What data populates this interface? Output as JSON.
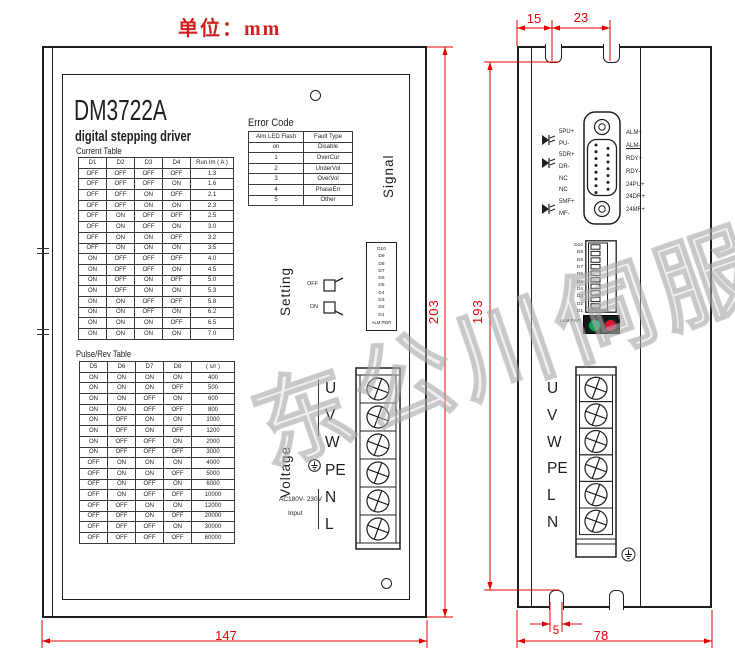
{
  "unit_label": "单位：mm",
  "watermark": "东公川伺服",
  "left_view": {
    "model": "DM3722A",
    "subtitle": "digital stepping driver",
    "signal_label": "Signal",
    "setting_label": "Setting",
    "voltage_label": "Voltage",
    "switch_off": "OFF",
    "switch_on": "ON",
    "dip_labels": [
      "D10",
      "D9",
      "D8",
      "D7",
      "D6",
      "D5",
      "D4",
      "D3",
      "D2",
      "D1"
    ],
    "dip_status_label": "ALM PWR",
    "terminals": [
      "U",
      "V",
      "W",
      "PE",
      "N",
      "L"
    ],
    "power_note": "AC180V- 230V",
    "power_note2": "Input",
    "current_table": {
      "title": "Current Table",
      "headers": [
        "D1",
        "D2",
        "D3",
        "D4",
        "Run Im ( A )"
      ],
      "rows": [
        [
          "OFF",
          "OFF",
          "OFF",
          "OFF",
          "1.3"
        ],
        [
          "OFF",
          "OFF",
          "OFF",
          "ON",
          "1.6"
        ],
        [
          "OFF",
          "OFF",
          "ON",
          "OFF",
          "2.1"
        ],
        [
          "OFF",
          "OFF",
          "ON",
          "ON",
          "2.3"
        ],
        [
          "OFF",
          "ON",
          "OFF",
          "OFF",
          "2.5"
        ],
        [
          "OFF",
          "ON",
          "OFF",
          "ON",
          "3.0"
        ],
        [
          "OFF",
          "ON",
          "ON",
          "OFF",
          "3.2"
        ],
        [
          "OFF",
          "ON",
          "ON",
          "ON",
          "3.5"
        ],
        [
          "ON",
          "OFF",
          "OFF",
          "OFF",
          "4.0"
        ],
        [
          "ON",
          "OFF",
          "OFF",
          "ON",
          "4.5"
        ],
        [
          "ON",
          "OFF",
          "ON",
          "OFF",
          "5.0"
        ],
        [
          "ON",
          "OFF",
          "ON",
          "ON",
          "5.3"
        ],
        [
          "ON",
          "ON",
          "OFF",
          "OFF",
          "5.8"
        ],
        [
          "ON",
          "ON",
          "OFF",
          "ON",
          "6.2"
        ],
        [
          "ON",
          "ON",
          "ON",
          "OFF",
          "6.5"
        ],
        [
          "ON",
          "ON",
          "ON",
          "ON",
          "7.0"
        ]
      ]
    },
    "pulse_table": {
      "title": "Pulse/Rev Table",
      "headers": [
        "D5",
        "D6",
        "D7",
        "D8",
        "( s/r )"
      ],
      "rows": [
        [
          "ON",
          "ON",
          "ON",
          "ON",
          "400"
        ],
        [
          "ON",
          "ON",
          "ON",
          "OFF",
          "500"
        ],
        [
          "ON",
          "ON",
          "OFF",
          "ON",
          "600"
        ],
        [
          "ON",
          "ON",
          "OFF",
          "OFF",
          "800"
        ],
        [
          "ON",
          "OFF",
          "ON",
          "ON",
          "1000"
        ],
        [
          "ON",
          "OFF",
          "ON",
          "OFF",
          "1200"
        ],
        [
          "ON",
          "OFF",
          "OFF",
          "ON",
          "2000"
        ],
        [
          "ON",
          "OFF",
          "OFF",
          "OFF",
          "3000"
        ],
        [
          "OFF",
          "ON",
          "ON",
          "ON",
          "4000"
        ],
        [
          "OFF",
          "ON",
          "ON",
          "OFF",
          "5000"
        ],
        [
          "OFF",
          "ON",
          "OFF",
          "ON",
          "6000"
        ],
        [
          "OFF",
          "ON",
          "OFF",
          "OFF",
          "10000"
        ],
        [
          "OFF",
          "OFF",
          "ON",
          "ON",
          "12000"
        ],
        [
          "OFF",
          "OFF",
          "ON",
          "OFF",
          "20000"
        ],
        [
          "OFF",
          "OFF",
          "OFF",
          "ON",
          "30000"
        ],
        [
          "OFF",
          "OFF",
          "OFF",
          "OFF",
          "60000"
        ]
      ]
    },
    "error_table": {
      "title": "Error Code",
      "headers": [
        "Alm LED Flash",
        "Fault Type"
      ],
      "rows": [
        [
          "on",
          "Disable"
        ],
        [
          "1",
          "OverCur"
        ],
        [
          "2",
          "UnderVol"
        ],
        [
          "3",
          "OverVol"
        ],
        [
          "4",
          "PhaseErr"
        ],
        [
          "5",
          "Other"
        ]
      ]
    }
  },
  "right_view": {
    "left_pins": [
      "5PU+",
      "PU-",
      "5DR+",
      "DR-",
      "NC",
      "NC",
      "5MF+",
      "MF-"
    ],
    "right_pins": [
      "ALM+",
      "ALM-",
      "RDY+",
      "RDY-",
      "24PU+",
      "24DR+",
      "24MF+"
    ],
    "dip_labels": [
      "D10",
      "D9",
      "D8",
      "D7",
      "D6",
      "D5",
      "D4",
      "D3",
      "D2",
      "D1"
    ],
    "led_label": "ALM PWR",
    "terminals": [
      "U",
      "V",
      "W",
      "PE",
      "L",
      "N"
    ]
  },
  "dims": {
    "front_width": "147",
    "body_height": "203",
    "mount_height": "193",
    "side_width": "78",
    "tab_offset": "15",
    "tab_pitch": "23",
    "slot_width": "5"
  },
  "colors": {
    "dimension_red": "#e60000",
    "led_green": "#00a651",
    "led_red": "#e8112d",
    "line_black": "#1f1f1f"
  }
}
